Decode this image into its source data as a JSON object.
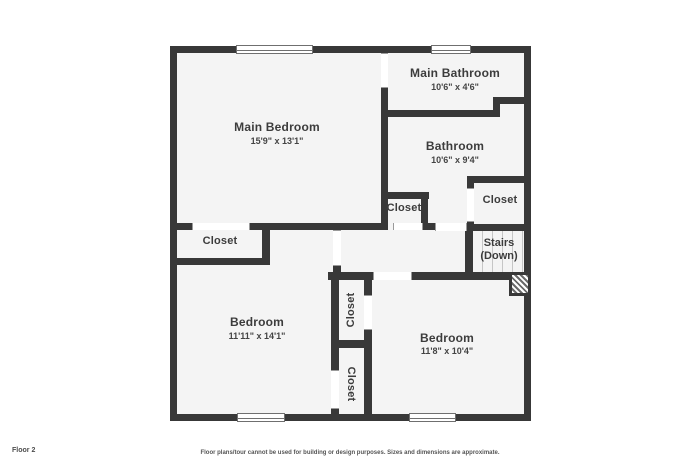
{
  "colors": {
    "wall": "#383838",
    "room_fill": "#f4f4f4",
    "text": "#3c3c3c"
  },
  "floor_label": "Floor 2",
  "disclaimer": "Floor plans/tour cannot be used for building or design purposes. Sizes and dimensions are approximate.",
  "rooms": {
    "main_bedroom": {
      "name": "Main Bedroom",
      "dims": "15'9\" x 13'1\""
    },
    "main_bathroom": {
      "name": "Main Bathroom",
      "dims": "10'6\" x 4'6\""
    },
    "bathroom": {
      "name": "Bathroom",
      "dims": "10'6\" x 9'4\""
    },
    "bedroom_left": {
      "name": "Bedroom",
      "dims": "11'11\" x 14'1\""
    },
    "bedroom_right": {
      "name": "Bedroom",
      "dims": "11'8\" x 10'4\""
    },
    "closet_main": {
      "name": "Closet"
    },
    "closet_hall": {
      "name": "Closet"
    },
    "closet_right": {
      "name": "Closet"
    },
    "closet_upper": {
      "name": "Closet"
    },
    "closet_lower": {
      "name": "Closet"
    },
    "stairs": {
      "name": "Stairs",
      "direction": "(Down)"
    }
  }
}
